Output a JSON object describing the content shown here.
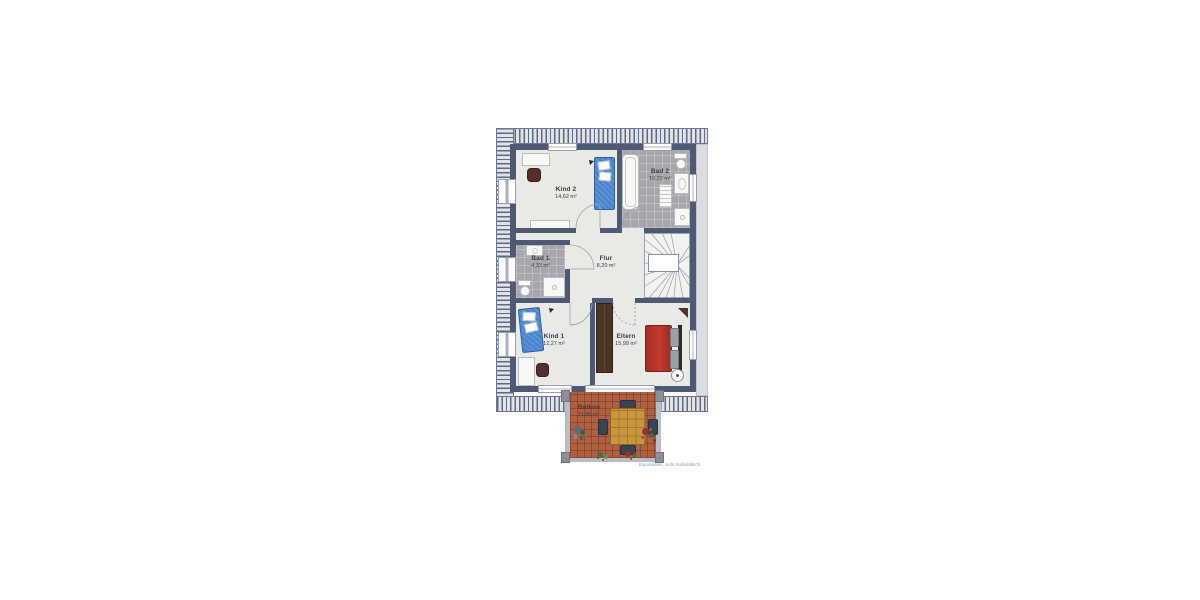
{
  "watermark": "Exposéplan, nicht maßstäblich",
  "rooms": [
    {
      "name": "Kind 2",
      "area": "14,62 m²"
    },
    {
      "name": "Bad 2",
      "area": "10,22 m²"
    },
    {
      "name": "Bad 1",
      "area": "4,33 m²"
    },
    {
      "name": "Flur",
      "area": "8,20 m²"
    },
    {
      "name": "Kind 1",
      "area": "12,27 m²"
    },
    {
      "name": "Eltern",
      "area": "15,99 m²"
    },
    {
      "name": "Balkon",
      "area": "11,50 m²"
    }
  ],
  "colors": {
    "wall": "#4e5a74",
    "room_floor": "#e9e9e6",
    "bath_tile": "#a6a6ac",
    "balcony_tile": "#b05f41",
    "bed_blue": "#4a86d0",
    "bed_red": "#b83228",
    "wood": "#c8963e",
    "wardrobe": "#4a3626",
    "label_text": "#3a3f46",
    "watermark_text": "#8a97b5"
  }
}
